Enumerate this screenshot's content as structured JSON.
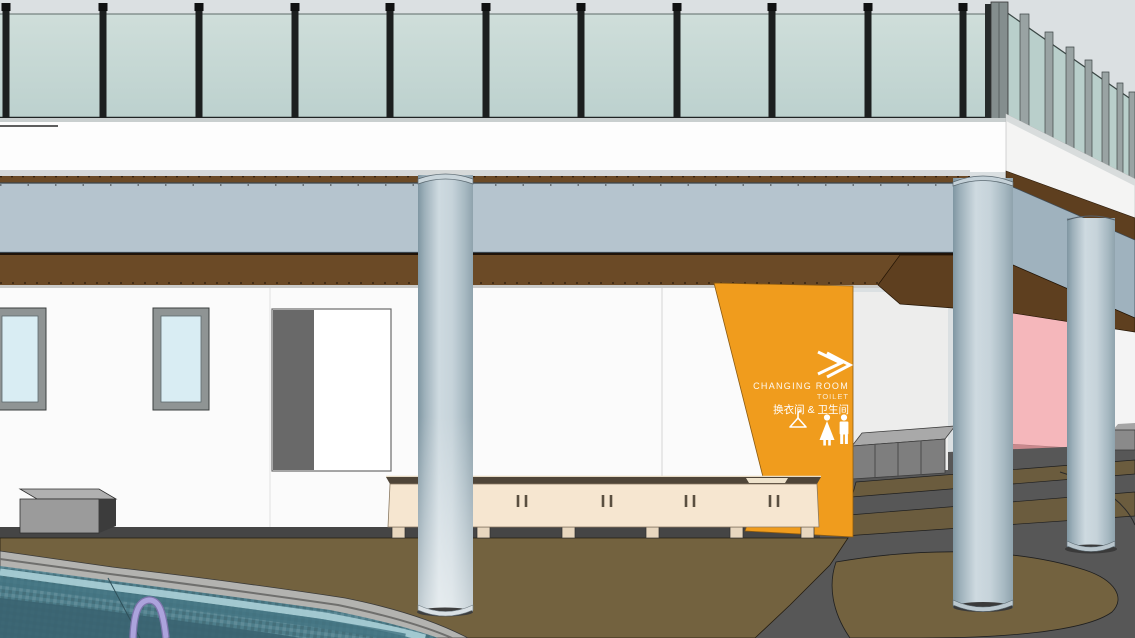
{
  "signage": {
    "arrow_icon": "double-chevron-right-icon",
    "title_en": "CHANGING ROOM",
    "subtitle_en": "TOILET",
    "title_zh": "换衣间 & 卫生间",
    "pictograms": [
      "hanger-icon",
      "woman-icon",
      "man-icon"
    ]
  },
  "colors": {
    "sky": "#DBE0E2",
    "glass_side": "#B9CFCB",
    "fascia": "#FDFDFD",
    "beam": "#B5C4CE",
    "beam_side": "#9FB2BE",
    "soffit_brown": "#6B4A26",
    "soffit_brown_dark": "#5E3F1F",
    "wall_white": "#FBFBFB",
    "window_glass": "#D9EDF3",
    "sign_orange": "#F09C1D",
    "panel_pink": "#F5B7BB",
    "bench_cream": "#F6E6D0",
    "bench_top": "#4F4538",
    "pool_tile": "#4E7E8B",
    "pool_waterline": "#A7CCD4",
    "pool_coping": "#B3B3B0",
    "ladder": "#ACA3DC",
    "deck_brown": "#73623F",
    "stripe_brown": "#6B5C3E",
    "path_gray": "#575757",
    "locker_gray": "#7E7E7E"
  }
}
